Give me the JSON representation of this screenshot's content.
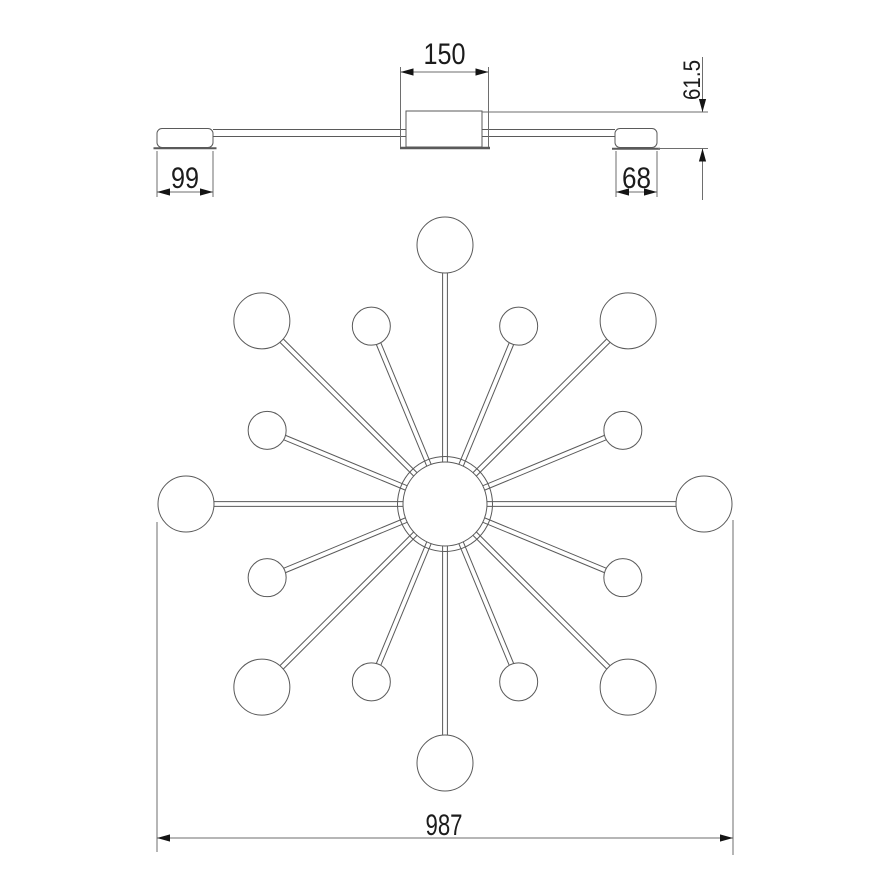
{
  "drawing": {
    "type": "technical-drawing",
    "subject": "sputnik-chandelier-16-lamp",
    "colors": {
      "background": "#ffffff",
      "line": "#5a5a5a",
      "dim_line": "#6e6e6e",
      "text": "#1c1c1c",
      "arrow": "#141414"
    },
    "dimensions": {
      "canopy_width": "150",
      "left_end_cap": "99",
      "right_end_cap": "68",
      "fixture_height": "61.5",
      "overall_width": "987"
    },
    "side_view": {
      "canopy_box": {
        "x": 406,
        "y": 111,
        "w": 76,
        "h": 36
      },
      "base_plate": {
        "x1": 400,
        "x2": 490,
        "y": 148,
        "w": 2.5
      },
      "left_cap": {
        "x": 157,
        "y": 128.5,
        "w": 56,
        "h": 19,
        "rx": 5
      },
      "left_cap_base": {
        "x1": 153.5,
        "x2": 216.5,
        "y": 148.2,
        "w": 2
      },
      "right_cap": {
        "x": 615,
        "y": 128.5,
        "w": 42,
        "h": 19,
        "rx": 5
      },
      "right_cap_base": {
        "x1": 612,
        "x2": 660,
        "y": 148.8,
        "w": 2
      },
      "tube": {
        "y_top": 129.5,
        "y_bottom": 136.5,
        "left": {
          "x1": 213,
          "x2": 406
        },
        "right": {
          "x1": 482,
          "x2": 615
        }
      }
    },
    "plan_view": {
      "center": {
        "x": 445,
        "y": 504
      },
      "hub_inner_r": 42,
      "hub_outer_r": 47.5,
      "arms": {
        "count": 16,
        "step_deg": 22.5,
        "tube_half_width": 2.4,
        "long": {
          "length": 259,
          "sphere_r": 28
        },
        "short": {
          "length": 192.5,
          "sphere_r": 19
        }
      }
    },
    "dims_geometry": {
      "d150": {
        "ext": [
          {
            "x": 400.5,
            "y1": 67,
            "y2": 147
          },
          {
            "x": 488.5,
            "y1": 67,
            "y2": 147
          }
        ],
        "line": {
          "x1": 400.5,
          "x2": 488.5,
          "y": 72
        }
      },
      "d99": {
        "ext": [
          {
            "x": 157,
            "y1": 151,
            "y2": 197
          },
          {
            "x": 213,
            "y1": 151,
            "y2": 197
          }
        ],
        "line": {
          "x1": 157,
          "x2": 213,
          "y": 192
        }
      },
      "d68": {
        "ext": [
          {
            "x": 616,
            "y1": 151,
            "y2": 197
          },
          {
            "x": 657,
            "y1": 151,
            "y2": 197
          }
        ],
        "line": {
          "x1": 616,
          "x2": 657,
          "y": 192
        }
      },
      "d615": {
        "h_ext": [
          {
            "x1": 482,
            "x2": 708,
            "y": 112
          },
          {
            "x1": 658,
            "x2": 708,
            "y": 148.5
          }
        ],
        "x": 702.5,
        "top": {
          "y1": 57,
          "tip": 112
        },
        "bottom": {
          "tip": 148.5,
          "y2": 200
        }
      },
      "d987": {
        "ext": [
          {
            "x": 157,
            "y1": 522,
            "y2": 852
          },
          {
            "x": 733,
            "y1": 520,
            "y2": 855
          }
        ],
        "line": {
          "x1": 157,
          "x2": 733,
          "y": 838
        }
      }
    }
  }
}
